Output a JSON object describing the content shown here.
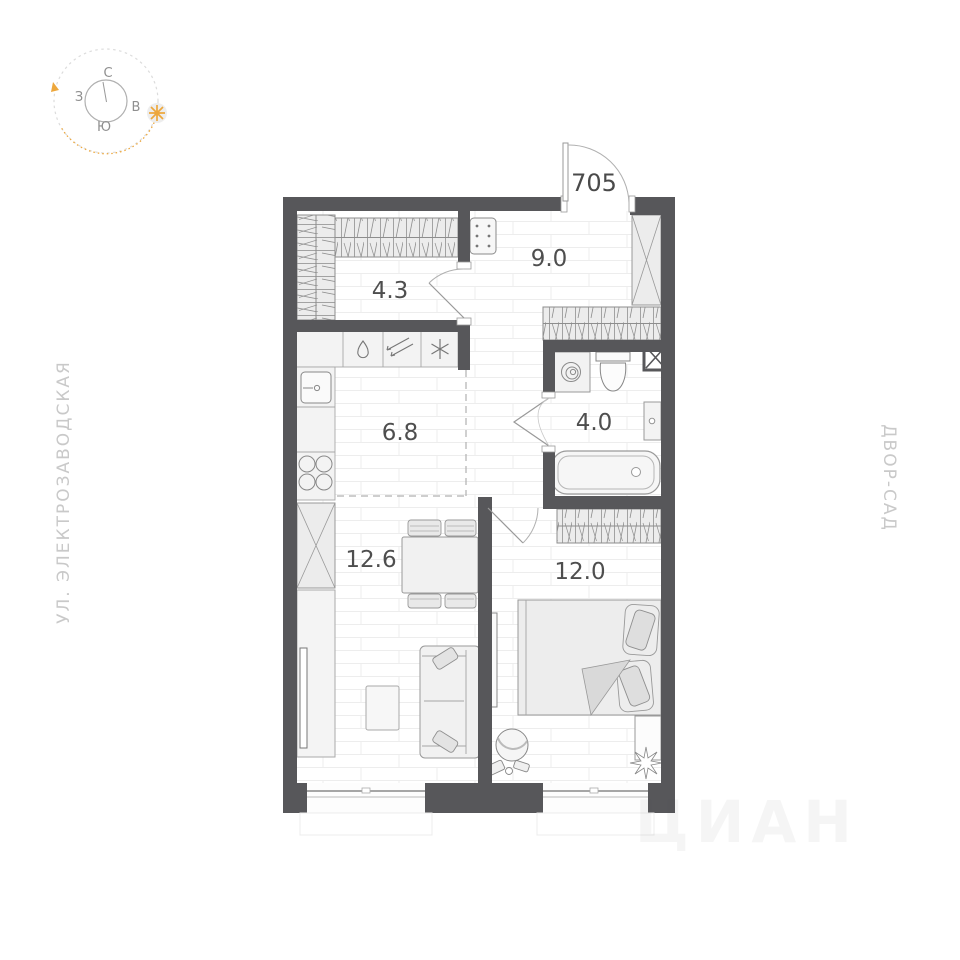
{
  "compass": {
    "north": "С",
    "south": "Ю",
    "west": "З",
    "east": "В"
  },
  "streets": {
    "left": "УЛ. ЭЛЕКТРОЗАВОДСКАЯ",
    "right": "ДВОР-САД"
  },
  "plan": {
    "apartment_number": "705",
    "rooms": {
      "hallway": {
        "area": "4.3"
      },
      "entry": {
        "area": "9.0"
      },
      "kitchen": {
        "area": "6.8"
      },
      "bathroom": {
        "area": "4.0"
      },
      "living_room": {
        "area": "12.6"
      },
      "bedroom": {
        "area": "12.0"
      }
    }
  },
  "watermark": {
    "text": "ЦИАН"
  },
  "colors": {
    "wall": "#57575a",
    "accent_orange": "#eda73c",
    "hatch_line": "#8f8f8f",
    "area_label_text": "#4e4e4e",
    "street_label_text": "#c9c9c9"
  }
}
